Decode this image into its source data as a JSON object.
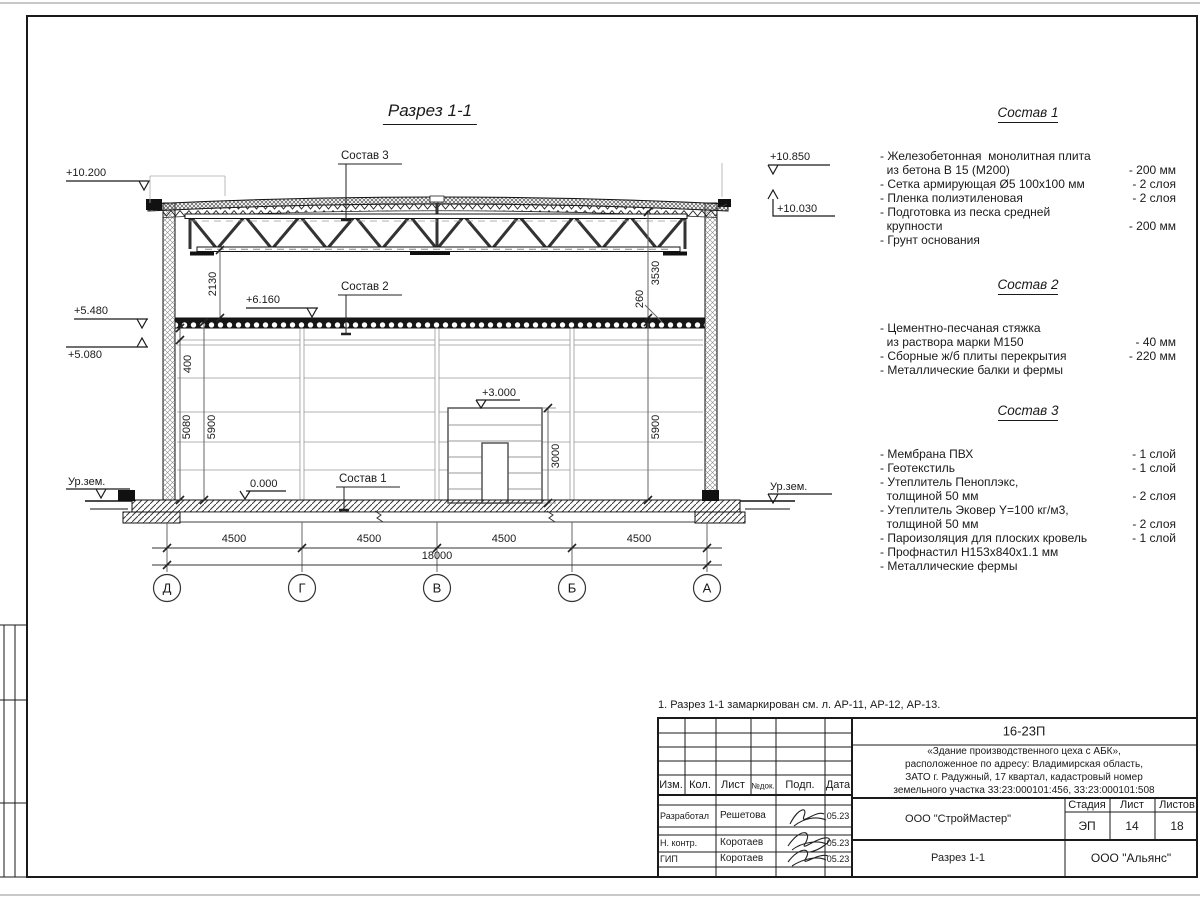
{
  "sheet": {
    "note": "1. Разрез 1-1 замаркирован см. л. АР-11, АР-12, АР-13."
  },
  "drawing": {
    "title": "Разрез 1-1",
    "callouts": {
      "c1": "Состав 1",
      "c2": "Состав 2",
      "c3": "Состав 3"
    },
    "elevations": {
      "left_top": "+10.200",
      "left_mid": "+5.480",
      "left_low": "+5.080",
      "right_top": "+10.850",
      "right_mid": "+10.030",
      "floor2": "+6.160",
      "mezz": "+3.000",
      "zero": "0.000",
      "ground_left": "Ур.зем.",
      "ground_right": "Ур.зем."
    },
    "dims": {
      "v2130": "2130",
      "v3530": "3530",
      "v260": "260",
      "v400": "400",
      "v5080": "5080",
      "v5900_left": "5900",
      "v5900_right": "5900",
      "v3000": "3000",
      "span": "4500",
      "total": "18000"
    },
    "axes": [
      {
        "label": "Д"
      },
      {
        "label": "Г"
      },
      {
        "label": "В"
      },
      {
        "label": "Б"
      },
      {
        "label": "А"
      }
    ]
  },
  "compositions": [
    {
      "title": "Состав 1",
      "items": [
        {
          "name": "- Железобетонная  монолитная плита\n  из бетона В 15 (М200)",
          "qty": "- 200 мм"
        },
        {
          "name": "- Сетка армирующая Ø5 100х100 мм",
          "qty": "- 2 слоя"
        },
        {
          "name": "- Пленка полиэтиленовая",
          "qty": "-  2 слоя"
        },
        {
          "name": "- Подготовка из песка средней\n  крупности",
          "qty": "- 200 мм"
        },
        {
          "name": "- Грунт основания",
          "qty": ""
        }
      ]
    },
    {
      "title": "Состав 2",
      "items": [
        {
          "name": "- Цементно-песчаная стяжка\n  из раствора марки М150",
          "qty": "- 40 мм"
        },
        {
          "name": "- Сборные ж/б плиты перекрытия",
          "qty": "- 220 мм"
        },
        {
          "name": "- Металлические балки и фермы",
          "qty": ""
        }
      ]
    },
    {
      "title": "Состав 3",
      "items": [
        {
          "name": "- Мембрана ПВХ",
          "qty": "- 1 слой"
        },
        {
          "name": "- Геотекстиль",
          "qty": "- 1 слой"
        },
        {
          "name": "- Утеплитель Пеноплэкс,\n  толщиной 50 мм",
          "qty": "- 2 слоя"
        },
        {
          "name": "- Утеплитель Эковер Y=100 кг/м3,\n  толщиной 50 мм",
          "qty": "- 2 слоя"
        },
        {
          "name": "- Пароизоляция для плоских кровель",
          "qty": "- 1 слой"
        },
        {
          "name": "- Профнастил Н153х840х1.1 мм",
          "qty": ""
        },
        {
          "name": "- Металлические фермы",
          "qty": ""
        }
      ]
    }
  ],
  "titleblock": {
    "doc_number": "16-23П",
    "project": "«Здание производственного цеха с АБК»,\nрасположенное по адресу: Владимирская область,\nЗАТО г. Радужный, 17 квартал, кадастровый номер\nземельного участка 33:23:000101:456, 33:23:000101:508",
    "columns": {
      "izm": "Изм.",
      "kol": "Кол.",
      "list": "Лист",
      "ndok": "№док.",
      "podp": "Подп.",
      "data": "Дата"
    },
    "rows": [
      {
        "role": "Разработал",
        "name": "Решетова",
        "date": "05.23"
      },
      {
        "role": "Н. контр.",
        "name": "Коротаев",
        "date": "05.23"
      },
      {
        "role": "ГИП",
        "name": "Коротаев",
        "date": "05.23"
      }
    ],
    "org": "ООО \"СтройМастер\"",
    "stage_label": "Стадия",
    "sheet_label": "Лист",
    "sheets_label": "Листов",
    "stage": "ЭП",
    "sheet_no": "14",
    "sheets_total": "18",
    "drawing_name": "Разрез 1-1",
    "contractor": "ООО \"Альянс\""
  }
}
